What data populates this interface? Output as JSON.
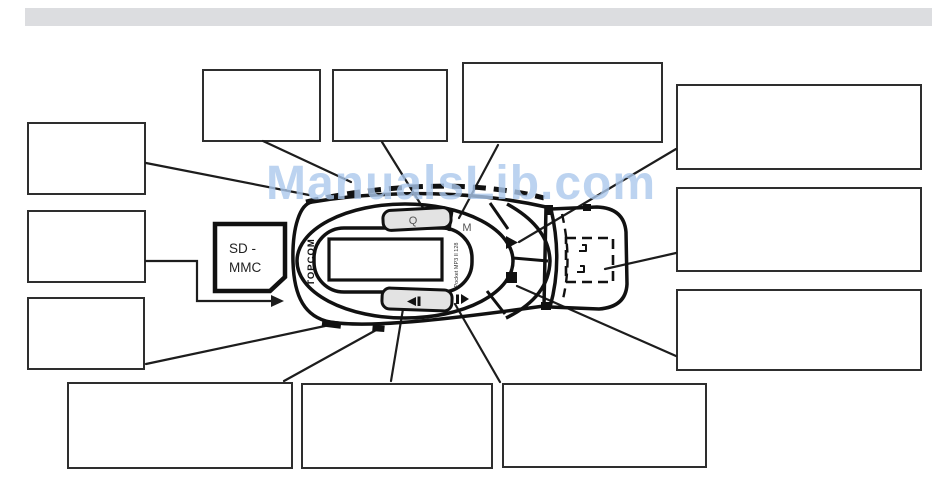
{
  "watermark": "ManualsLib.com",
  "colors": {
    "header_bar": "#dcdde0",
    "device_body": "#e3e3e3",
    "watermark_blue": "#abc8ec",
    "line_black": "#1d1d1d"
  },
  "device": {
    "brand": "TOPCOM",
    "model": "Pocket MP3 II 128",
    "buttons": {
      "q_label": "Q",
      "m_label": "M",
      "icons": {
        "play": "▶",
        "stop": "■",
        "previous": "◀❙",
        "next": "❙▶"
      }
    },
    "card_slot": {
      "line1": "SD -",
      "line2": "MMC"
    },
    "battery_compartment": "dashed outline"
  },
  "callouts": [
    {
      "id": "left-1",
      "label": ""
    },
    {
      "id": "left-2",
      "label": ""
    },
    {
      "id": "left-3",
      "label": ""
    },
    {
      "id": "top-1",
      "label": ""
    },
    {
      "id": "top-2",
      "label": ""
    },
    {
      "id": "top-3",
      "label": ""
    },
    {
      "id": "right-1",
      "label": ""
    },
    {
      "id": "right-2",
      "label": ""
    },
    {
      "id": "right-3",
      "label": ""
    },
    {
      "id": "bottom-1",
      "label": ""
    },
    {
      "id": "bottom-2",
      "label": ""
    },
    {
      "id": "bottom-3",
      "label": ""
    }
  ]
}
